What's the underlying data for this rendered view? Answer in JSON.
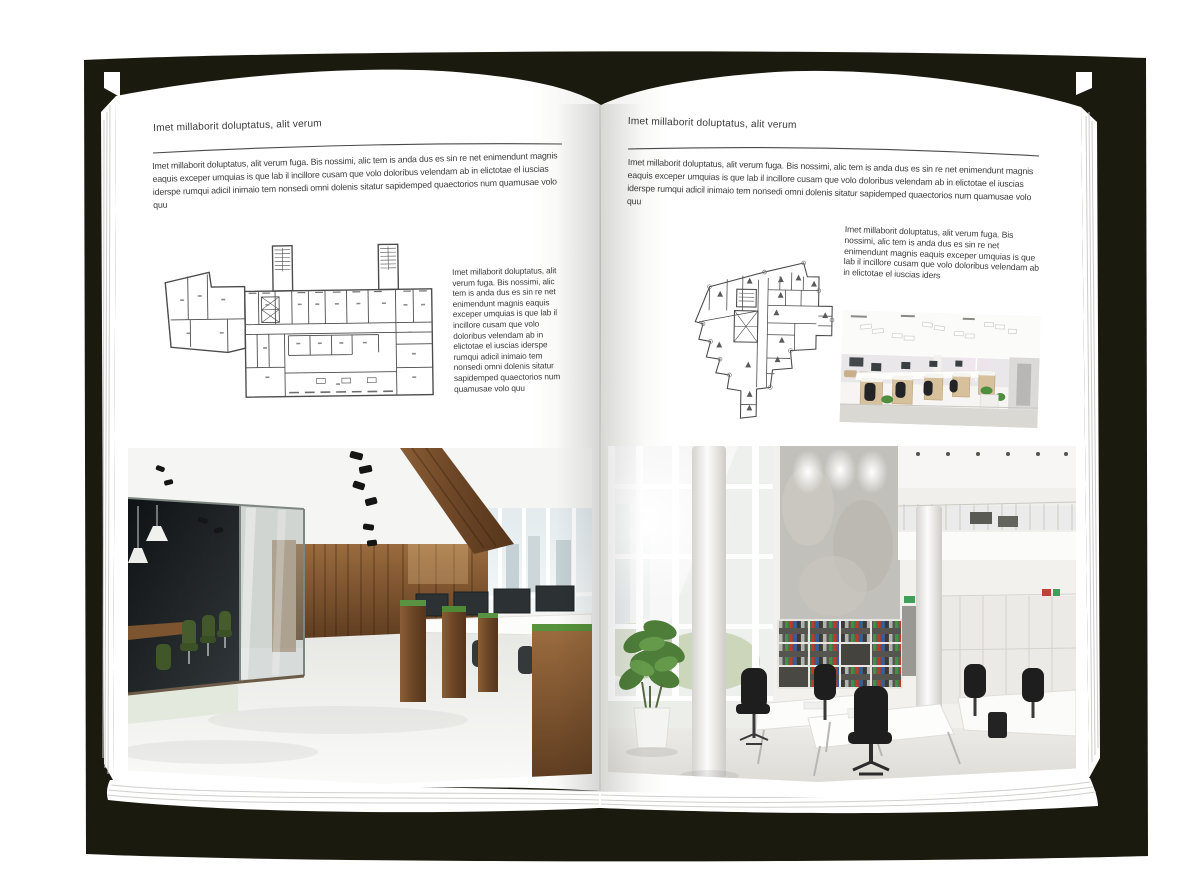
{
  "palette": {
    "background": "#ffffff",
    "book_shadow": "#1b1a0e",
    "page": "#ffffff",
    "text": "#3b3b3b",
    "rule": "#4a4a4a",
    "plan_line": "#4b4b4b",
    "photo_wood": "#7a5531",
    "photo_plant_green": "#579340",
    "binder_green": "#3f9147",
    "binder_red": "#c0392b",
    "binder_blue": "#2e5fa3"
  },
  "left_page": {
    "header": "Imet millaborit doluptatus, alit verum",
    "intro": "Imet millaborit doluptatus, alit verum fuga. Bis nossimi, alic tem is anda dus es sin re net enimendunt magnis eaquis exceper umquias is que lab il incillore cusam que volo doloribus velendam ab in elictotae el iuscias iderspe rumqui adicil inimaio tem nonsedi omni dolenis sitatur sapidemped quaectorios num quamusae volo quu",
    "side_text": "Imet millaborit doluptatus, alit verum fuga. Bis nossimi, alic tem is anda dus es sin re net enimendunt magnis eaquis exceper umquias is que lab il incillore cusam que volo doloribus velendam ab in elictotae el iuscias iderspe rumqui adicil inimaio tem nonsedi omni dolenis sitatur sapidemped quaectorios num quamusae volo quu"
  },
  "right_page": {
    "header": "Imet millaborit doluptatus, alit verum",
    "intro": "Imet millaborit doluptatus, alit verum fuga. Bis nossimi, alic tem is anda dus es sin re net enimendunt magnis eaquis exceper umquias is que lab il incillore cusam que volo doloribus velendam ab in elictotae el iuscias iderspe rumqui adicil inimaio tem nonsedi omni dolenis sitatur sapidemped quaectorios num quamusae volo quu",
    "side_text": "Imet millaborit doluptatus, alit verum fuga. Bis nossimi, alic tem is anda dus es sin re net enimendunt magnis eaquis exceper umquias is que lab il incillore cusam que volo doloribus velendam ab in elictotae el iuscias iders"
  }
}
